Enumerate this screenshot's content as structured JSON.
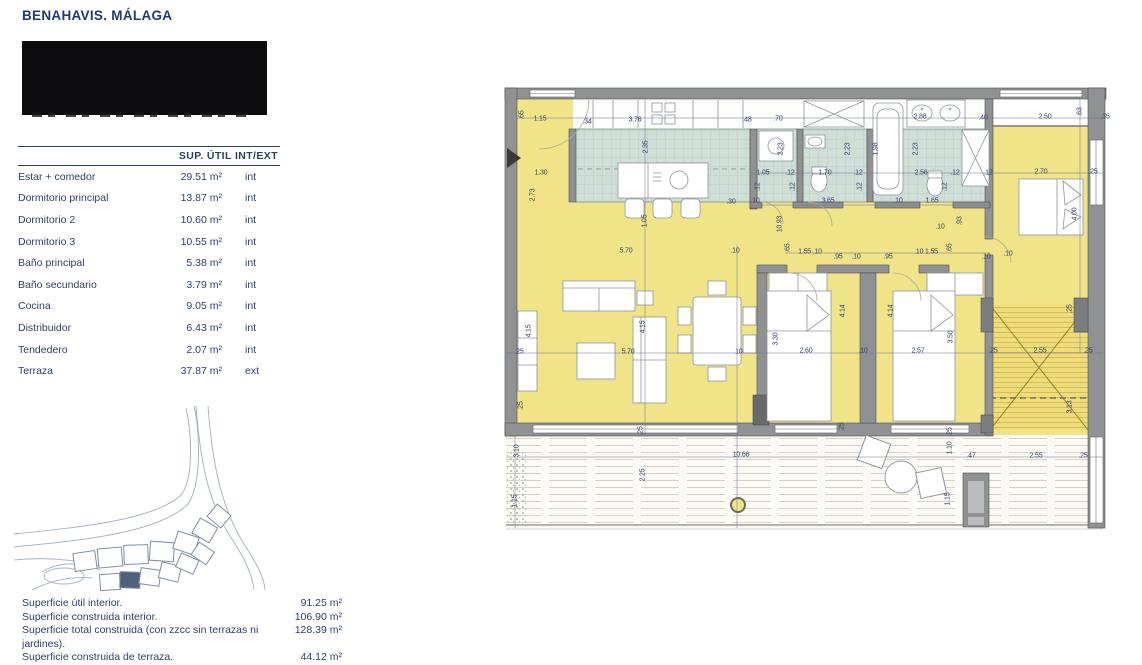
{
  "header": {
    "title": "BENAHAVIS. MÁLAGA"
  },
  "table": {
    "header": "SUP. ÚTIL INT/EXT",
    "rows": [
      {
        "label": "Estar + comedor",
        "area": "29.51 m²",
        "type": "int"
      },
      {
        "label": "Dormitorio principal",
        "area": "13.87 m²",
        "type": "int"
      },
      {
        "label": "Dormitorio 2",
        "area": "10.60 m²",
        "type": "int"
      },
      {
        "label": "Dormitorio 3",
        "area": "10.55 m²",
        "type": "int"
      },
      {
        "label": "Baño principal",
        "area": "5.38 m²",
        "type": "int"
      },
      {
        "label": "Baño secundario",
        "area": "3.79 m²",
        "type": "int"
      },
      {
        "label": "Cocina",
        "area": "9.05 m²",
        "type": "int"
      },
      {
        "label": "Distribuidor",
        "area": "6.43 m²",
        "type": "int"
      },
      {
        "label": "Tendedero",
        "area": "2.07 m²",
        "type": "int"
      },
      {
        "label": "Terraza",
        "area": "37.87 m²",
        "type": "ext"
      }
    ]
  },
  "summary": {
    "rows": [
      {
        "label": "Superficie útil interior.",
        "value": "91.25 m²"
      },
      {
        "label": "Superficie construida interior.",
        "value": "106.90 m²"
      },
      {
        "label": "Superficie total construida (con zzcc sin terrazas ni jardines).",
        "value": "128.39 m²"
      },
      {
        "label": "Superficie construida de terraza.",
        "value": "44.12 m²"
      }
    ]
  },
  "plan": {
    "colors": {
      "room_fill": "#f1e488",
      "tile_fill": "#d0ded8",
      "wall": "#8f9193",
      "hatch_line": "#c9ae4a",
      "deck_line": "#d8d3c4",
      "dim_text": "#35426b"
    },
    "dim_labels": [
      [
        ".65",
        19,
        30,
        1
      ],
      [
        "1.15",
        37,
        34,
        0
      ],
      [
        ".34",
        84,
        37,
        0
      ],
      [
        "3.76",
        132,
        35,
        0
      ],
      [
        ".48",
        244,
        35,
        0
      ],
      [
        ".70",
        275,
        34,
        0
      ],
      [
        "2.88",
        417,
        32,
        0
      ],
      [
        ".40",
        480,
        33,
        0
      ],
      [
        "2.50",
        542,
        32,
        0
      ],
      [
        ".63",
        577,
        27,
        1
      ],
      [
        ".35",
        602,
        32,
        0
      ],
      [
        "1.30",
        38,
        88,
        0
      ],
      [
        "2.73",
        30,
        110,
        1
      ],
      [
        "2.35",
        143,
        62,
        1
      ],
      [
        "1.05",
        142,
        136,
        1
      ],
      [
        "5.70",
        123,
        166,
        0
      ],
      [
        ".10",
        232,
        166,
        0
      ],
      [
        ".30",
        228,
        117,
        0
      ],
      [
        "1.05",
        260,
        88,
        0
      ],
      [
        ".12",
        287,
        88,
        0
      ],
      [
        "1.70",
        322,
        88,
        0
      ],
      [
        ".12",
        355,
        88,
        0
      ],
      [
        "2.56",
        418,
        88,
        0
      ],
      [
        ".12",
        452,
        88,
        0
      ],
      [
        ".12",
        485,
        88,
        0
      ],
      [
        "2.70",
        538,
        87,
        0
      ],
      [
        ".25",
        590,
        87,
        0
      ],
      [
        "2.23",
        278,
        64,
        1
      ],
      [
        "2.23",
        345,
        64,
        1
      ],
      [
        "1.98",
        373,
        64,
        1
      ],
      [
        "2.23",
        413,
        64,
        1
      ],
      [
        ".12",
        255,
        102,
        1
      ],
      [
        ".12",
        290,
        102,
        1
      ],
      [
        ".12",
        357,
        102,
        1
      ],
      [
        ".12",
        442,
        102,
        1
      ],
      [
        ".10",
        252,
        116,
        0
      ],
      [
        "3.65",
        325,
        116,
        0
      ],
      [
        ".10",
        395,
        116,
        0
      ],
      [
        "1.65",
        429,
        116,
        0
      ],
      [
        "10.93",
        277,
        139,
        1
      ],
      [
        ".10",
        437,
        142,
        0
      ],
      [
        ".93",
        457,
        136,
        1
      ],
      [
        "4.00",
        572,
        129,
        1
      ],
      [
        ".10",
        505,
        169,
        0
      ],
      [
        ".65",
        285,
        163,
        1
      ],
      [
        "1.55 .10",
        307,
        167,
        0
      ],
      [
        ".95",
        335,
        172,
        0
      ],
      [
        ".10",
        353,
        172,
        0
      ],
      [
        ".95",
        385,
        172,
        0
      ],
      [
        ".10 1.55",
        423,
        167,
        0
      ],
      [
        ".65",
        447,
        163,
        1
      ],
      [
        ".10",
        483,
        172,
        0
      ],
      [
        ".25",
        16,
        267,
        0
      ],
      [
        "5.70",
        125,
        267,
        0
      ],
      [
        ".10",
        235,
        267,
        0
      ],
      [
        "2.60",
        303,
        266,
        0
      ],
      [
        ".10",
        360,
        266,
        0
      ],
      [
        "2.57",
        415,
        266,
        0
      ],
      [
        ".25",
        490,
        266,
        0
      ],
      [
        "2.55",
        537,
        266,
        0
      ],
      [
        ".25",
        585,
        266,
        0
      ],
      [
        "4.15",
        26,
        246,
        1
      ],
      [
        ".25",
        18,
        321,
        1
      ],
      [
        "4.15",
        140,
        242,
        1
      ],
      [
        "3.30",
        273,
        254,
        1
      ],
      [
        "4.14",
        340,
        226,
        1
      ],
      [
        "4.14",
        388,
        226,
        1
      ],
      [
        "3.50",
        448,
        252,
        1
      ],
      [
        ".25",
        567,
        224,
        1
      ],
      [
        "3.13",
        567,
        322,
        1
      ],
      [
        ".25",
        339,
        342,
        1
      ],
      [
        ".25",
        138,
        346,
        1
      ],
      [
        "10.66",
        238,
        370,
        0
      ],
      [
        "2.25",
        140,
        390,
        1
      ],
      [
        ".25",
        447,
        347,
        1
      ],
      [
        "1.10",
        447,
        363,
        1
      ],
      [
        ".47",
        468,
        371,
        0
      ],
      [
        "2.55",
        533,
        371,
        0
      ],
      [
        ".25",
        580,
        371,
        0
      ],
      [
        "1.15",
        445,
        414,
        1
      ],
      [
        "3.10",
        14,
        366,
        1
      ],
      [
        "1.15",
        12,
        416,
        1
      ]
    ]
  }
}
